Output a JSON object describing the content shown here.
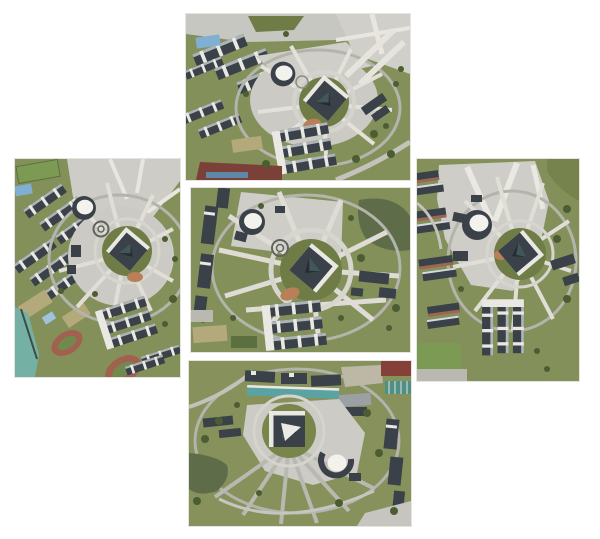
{
  "page": {
    "background": "#ffffff",
    "title": "Five aerial photographs of a campus arranged in a cross layout"
  },
  "palette": {
    "page_bg": "#ffffff",
    "pavement": "#cccbc5",
    "pavement_light": "#d6d5cf",
    "path_white": "#e3e1da",
    "grass": "#84905a",
    "grass_dark": "#6f7c46",
    "field_green": "#7d9a55",
    "tree": "#4c5c33",
    "building_dark": "#3a4149",
    "building_darker": "#262c31",
    "roof_white": "#e9e8e3",
    "roof_light": "#aeb4b6",
    "dome_white": "#f3f2ed",
    "water_pond": "#5e6c49",
    "water_teal": "#75b0a5",
    "track_red": "#a2604e",
    "track_infield": "#71894c",
    "khaki": "#b4a97b",
    "court_blue": "#7fb0d4",
    "teal_roof": "#5ba3a3",
    "red_roof": "#86403a",
    "teal_court": "#4f8f86",
    "soil_orange": "#b97f57",
    "ring_road": "#b3b4ac",
    "maroon_track": "#7b4038"
  },
  "tiles": [
    {
      "position": "top",
      "left": 186,
      "top": 14,
      "width": 224,
      "height": 166,
      "alt": "Oblique aerial view of campus plaza with cube building, dome and dormitories"
    },
    {
      "position": "left",
      "left": 15,
      "top": 159,
      "width": 165,
      "height": 218,
      "alt": "Aerial view with dormitory rows, running tracks and river on the left"
    },
    {
      "position": "center",
      "left": 191,
      "top": 188,
      "width": 219,
      "height": 164,
      "alt": "Near-nadir aerial view of the circular plaza and cube building"
    },
    {
      "position": "right",
      "left": 417,
      "top": 159,
      "width": 162,
      "height": 222,
      "alt": "Aerial view with large paved plaza, dome and cube building"
    },
    {
      "position": "bottom",
      "left": 189,
      "top": 361,
      "width": 222,
      "height": 165,
      "alt": "Aerial view from opposite side with lawn fan paths and dome"
    }
  ]
}
